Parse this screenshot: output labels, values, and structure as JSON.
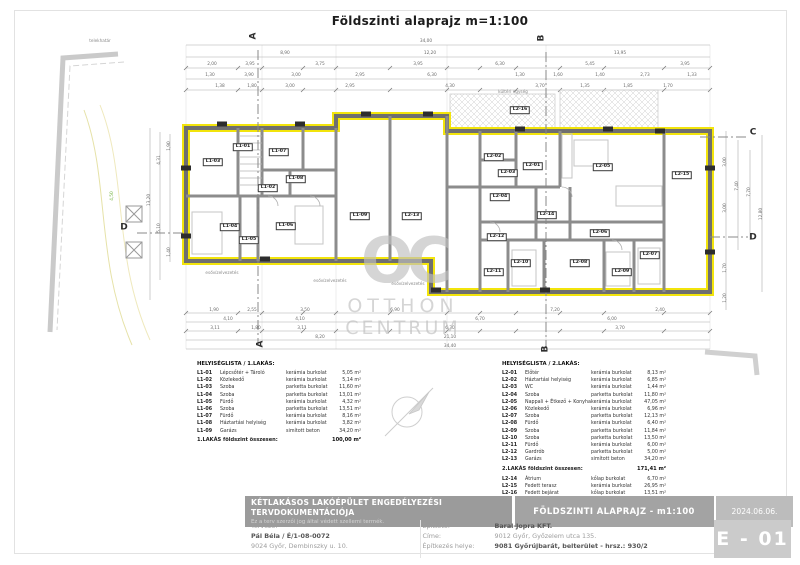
{
  "title": "Földszinti alaprajz m=1:100",
  "watermark": {
    "logo": "OC",
    "line1": "OTTHON",
    "line2": "CENTRUM"
  },
  "colors": {
    "wall_highlight": "#f2e40c",
    "section_line": "#888888",
    "terrain_green": "#7ab648"
  },
  "plan": {
    "section_markers": [
      {
        "t": "A",
        "x": 254,
        "y": 36,
        "r": 1
      },
      {
        "t": "A",
        "x": 261,
        "y": 344,
        "r": 1
      },
      {
        "t": "B",
        "x": 542,
        "y": 38,
        "r": 1
      },
      {
        "t": "B",
        "x": 546,
        "y": 349,
        "r": 1
      },
      {
        "t": "C",
        "x": 753,
        "y": 133,
        "r": 0
      },
      {
        "t": "D",
        "x": 753,
        "y": 238,
        "r": 0
      },
      {
        "t": "D",
        "x": 124,
        "y": 228,
        "r": 0
      }
    ],
    "room_tags": [
      [
        243,
        147,
        "L1-01"
      ],
      [
        268,
        188,
        "L1-02"
      ],
      [
        213,
        162,
        "L1-03"
      ],
      [
        230,
        227,
        "L1-04"
      ],
      [
        249,
        240,
        "L1-05"
      ],
      [
        286,
        226,
        "L1-06"
      ],
      [
        279,
        152,
        "L1-07"
      ],
      [
        296,
        179,
        "L1-08"
      ],
      [
        360,
        216,
        "L1-09"
      ],
      [
        412,
        216,
        "L2-13"
      ],
      [
        533,
        166,
        "L2-01"
      ],
      [
        494,
        157,
        "L2-02"
      ],
      [
        508,
        173,
        "L2-03"
      ],
      [
        500,
        197,
        "L2-04"
      ],
      [
        603,
        167,
        "L2-05"
      ],
      [
        600,
        233,
        "L2-06"
      ],
      [
        650,
        255,
        "L2-07"
      ],
      [
        580,
        263,
        "L2-08"
      ],
      [
        622,
        272,
        "L2-09"
      ],
      [
        521,
        263,
        "L2-10"
      ],
      [
        494,
        272,
        "L2-11"
      ],
      [
        497,
        237,
        "L2-12"
      ],
      [
        547,
        215,
        "L2-14"
      ],
      [
        682,
        175,
        "L2-15"
      ],
      [
        520,
        110,
        "L2-16"
      ]
    ],
    "opening_tags": [
      [
        222,
        124
      ],
      [
        300,
        124
      ],
      [
        366,
        114
      ],
      [
        428,
        114
      ],
      [
        520,
        129
      ],
      [
        608,
        129
      ],
      [
        186,
        168
      ],
      [
        186,
        236
      ],
      [
        710,
        168
      ],
      [
        710,
        252
      ],
      [
        265,
        259
      ],
      [
        436,
        290
      ],
      [
        545,
        290
      ],
      [
        660,
        131
      ]
    ],
    "dimensions": [
      [
        426,
        42,
        "34,00",
        0
      ],
      [
        285,
        54,
        "8,90",
        0
      ],
      [
        430,
        54,
        "12,20",
        0
      ],
      [
        620,
        54,
        "13,95",
        0
      ],
      [
        212,
        65,
        "2,00",
        0
      ],
      [
        250,
        65,
        "3,95",
        0
      ],
      [
        320,
        65,
        "3,75",
        0
      ],
      [
        418,
        65,
        "3,95",
        0
      ],
      [
        500,
        65,
        "6,30",
        0
      ],
      [
        590,
        65,
        "5,45",
        0
      ],
      [
        685,
        65,
        "3,95",
        0
      ],
      [
        210,
        76,
        "1,30",
        0
      ],
      [
        249,
        76,
        "3,90",
        0
      ],
      [
        296,
        76,
        "3,00",
        0
      ],
      [
        360,
        76,
        "2,95",
        0
      ],
      [
        432,
        76,
        "6,30",
        0
      ],
      [
        520,
        76,
        "1,30",
        0
      ],
      [
        558,
        76,
        "1,60",
        0
      ],
      [
        600,
        76,
        "1,40",
        0
      ],
      [
        645,
        76,
        "2,73",
        0
      ],
      [
        692,
        76,
        "1,33",
        0
      ],
      [
        220,
        87,
        "1,38",
        0
      ],
      [
        252,
        87,
        "1,80",
        0
      ],
      [
        290,
        87,
        "3,00",
        0
      ],
      [
        350,
        87,
        "2,95",
        0
      ],
      [
        450,
        87,
        "4,30",
        0
      ],
      [
        540,
        87,
        "3,70",
        0
      ],
      [
        585,
        87,
        "1,35",
        0
      ],
      [
        628,
        87,
        "1,85",
        0
      ],
      [
        668,
        87,
        "1,70",
        0
      ],
      [
        214,
        311,
        "1,90",
        0
      ],
      [
        252,
        311,
        "2,55",
        0
      ],
      [
        305,
        311,
        "3,50",
        0
      ],
      [
        395,
        311,
        "6,90",
        0
      ],
      [
        555,
        311,
        "7,20",
        0
      ],
      [
        660,
        311,
        "2,40",
        0
      ],
      [
        228,
        320,
        "4,10",
        0
      ],
      [
        300,
        320,
        "4,10",
        0
      ],
      [
        480,
        320,
        "6,70",
        0
      ],
      [
        612,
        320,
        "6,00",
        0
      ],
      [
        215,
        329,
        "3,11",
        0
      ],
      [
        256,
        329,
        "1,80",
        0
      ],
      [
        302,
        329,
        "3,11",
        0
      ],
      [
        450,
        329,
        "6,30",
        0
      ],
      [
        620,
        329,
        "3,70",
        0
      ],
      [
        320,
        338,
        "8,20",
        0
      ],
      [
        450,
        338,
        "21,10",
        0
      ],
      [
        450,
        347,
        "34,40",
        0
      ],
      [
        150,
        200,
        "13,20",
        1
      ],
      [
        160,
        160,
        "4,31",
        1
      ],
      [
        160,
        228,
        "5,10",
        1
      ],
      [
        170,
        146,
        "1,90",
        1
      ],
      [
        170,
        252,
        "1,40",
        1
      ],
      [
        726,
        162,
        "3,00",
        1
      ],
      [
        726,
        208,
        "3,00",
        1
      ],
      [
        726,
        268,
        "1,70",
        1
      ],
      [
        738,
        186,
        "7,40",
        1
      ],
      [
        750,
        192,
        "7,70",
        1
      ],
      [
        762,
        214,
        "12,80",
        1
      ],
      [
        726,
        298,
        "1,20",
        1
      ],
      [
        113,
        196,
        "4,50",
        1,
        "g"
      ]
    ],
    "notes": [
      [
        100,
        41,
        "telekhatár"
      ],
      [
        222,
        273,
        "esővízelvezetés"
      ],
      [
        330,
        281,
        "esővízelvezetés"
      ],
      [
        408,
        284,
        "esővízelvezetés"
      ],
      [
        513,
        92,
        "kültéri egység"
      ]
    ]
  },
  "lists": {
    "list1": {
      "title": "HELYISÉGLISTA / 1.LAKÁS:",
      "rows": [
        [
          "L1-01",
          "Lépcsőtér + Tároló",
          "kerámia burkolat",
          "5,05 m²"
        ],
        [
          "L1-02",
          "Közlekedő",
          "kerámia burkolat",
          "5,14 m²"
        ],
        [
          "L1-03",
          "Szoba",
          "parketta burkolat",
          "11,60 m²"
        ],
        [
          "L1-04",
          "Szoba",
          "parketta burkolat",
          "13,01 m²"
        ],
        [
          "L1-05",
          "Fürdő",
          "kerámia burkolat",
          "4,32 m²"
        ],
        [
          "L1-06",
          "Szoba",
          "parketta burkolat",
          "13,51 m²"
        ],
        [
          "L1-07",
          "Fürdő",
          "kerámia burkolat",
          "8,16 m²"
        ],
        [
          "L1-08",
          "Háztartási helyiség",
          "kerámia burkolat",
          "3,82 m²"
        ],
        [
          "L1-09",
          "Garázs",
          "simított beton",
          "34,20 m²"
        ]
      ],
      "total_label": "1.LAKÁS földszint összesen:",
      "total_value": "100,00 m²"
    },
    "list2": {
      "title": "HELYISÉGLISTA / 2.LAKÁS:",
      "rows": [
        [
          "L2-01",
          "Előtér",
          "kerámia burkolat",
          "8,13 m²"
        ],
        [
          "L2-02",
          "Háztartási helyiség",
          "kerámia burkolat",
          "6,85 m²"
        ],
        [
          "L2-03",
          "WC",
          "kerámia burkolat",
          "1,44 m²"
        ],
        [
          "L2-04",
          "Szoba",
          "parketta burkolat",
          "11,80 m²"
        ],
        [
          "L2-05",
          "Nappali + Étkező + Konyha",
          "kerámia burkolat",
          "47,05 m²"
        ],
        [
          "L2-06",
          "Közlekedő",
          "kerámia burkolat",
          "6,96 m²"
        ],
        [
          "L2-07",
          "Szoba",
          "parketta burkolat",
          "12,13 m²"
        ],
        [
          "L2-08",
          "Fürdő",
          "kerámia burkolat",
          "6,40 m²"
        ],
        [
          "L2-09",
          "Szoba",
          "parketta burkolat",
          "11,84 m²"
        ],
        [
          "L2-10",
          "Szoba",
          "parketta burkolat",
          "13,50 m²"
        ],
        [
          "L2-11",
          "Fürdő",
          "kerámia burkolat",
          "6,00 m²"
        ],
        [
          "L2-12",
          "Gardrób",
          "parketta burkolat",
          "5,00 m²"
        ],
        [
          "L2-13",
          "Garázs",
          "simított beton",
          "34,20 m²"
        ]
      ],
      "total_label": "2.LAKÁS földszint összesen:",
      "total_value": "171,41 m²",
      "extra_rows": [
        [
          "L2-14",
          "Átrium",
          "kőlap burkolat",
          "6,70 m²"
        ],
        [
          "L2-15",
          "Fedett terasz",
          "kerámia burkolat",
          "26,95 m²"
        ],
        [
          "L2-16",
          "Fedett bejárat",
          "kőlap burkolat",
          "13,51 m²"
        ]
      ]
    }
  },
  "footer": {
    "project_title": "KÉTLAKÁSOS LAKÓÉPÜLET ENGEDÉLYEZÉSI TERVDOKUMENTÁCIÓJA",
    "copyright": "Ez a terv szerzői jog által védett szellemi termék.",
    "drawing_title": "FÖLDSZINTI ALAPRAJZ - m1:100",
    "date": "2024.06.06.",
    "sheet_number": "E - 01",
    "designer_label": "Tervező:",
    "designer_name": "Pál Béla / É/1-08-0072",
    "designer_address": "9024 Győr, Dembinszky u. 10.",
    "client_label": "Építtető:",
    "client_name": "Baral-Jopra KFT.",
    "client_address_label": "Címe:",
    "client_address": "9012 Győr, Győzelem utca 135.",
    "site_label": "Építkezés helye:",
    "site_value": "9081 Győrújbarát, belterület  -  hrsz.: 930/2"
  }
}
